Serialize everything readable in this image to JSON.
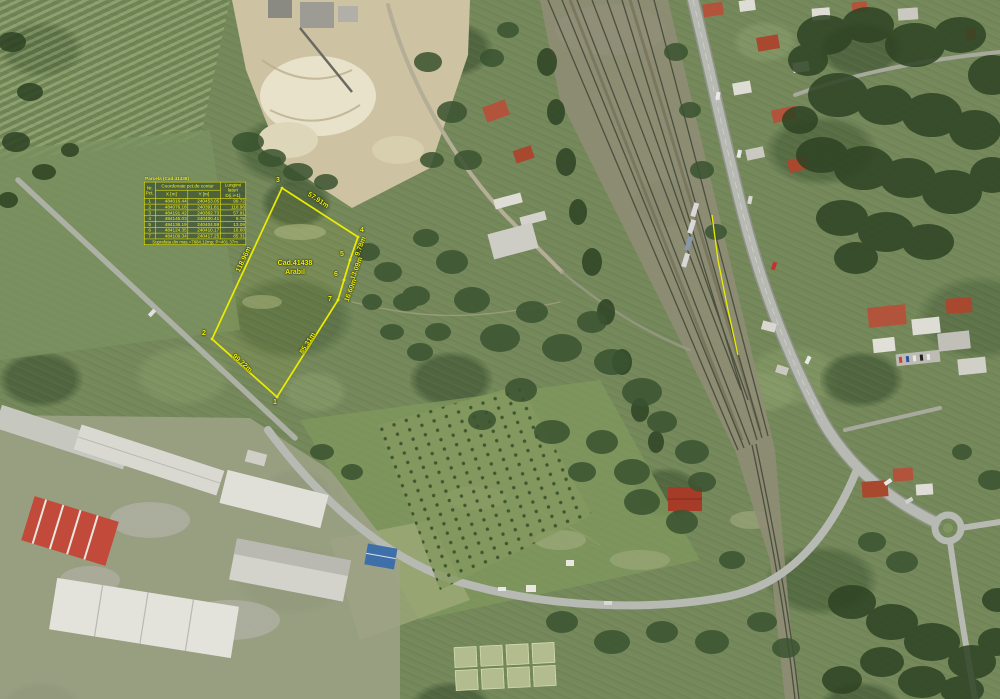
{
  "colors": {
    "overlay_yellow": "#f2f200"
  },
  "parcel": {
    "id_label": "Cad.41438",
    "use_label": "Arabil",
    "vertices": [
      "1",
      "2",
      "3",
      "4",
      "5",
      "6",
      "7"
    ],
    "edge_labels": [
      {
        "text": "57.91m"
      },
      {
        "text": "9.78m"
      },
      {
        "text": "13.09m"
      },
      {
        "text": "16.60m"
      },
      {
        "text": "85.31m"
      },
      {
        "text": "99.72m"
      },
      {
        "text": "118.96m"
      }
    ]
  },
  "coord_table": {
    "title": "Parcela (Cad.41438)",
    "header": {
      "nr": "Nr. Pct.",
      "coord": "Coordonate pct.de contur",
      "x": "X [m]",
      "y": "Y [m]",
      "len": "Lungimi laturi D(i,i+1)"
    },
    "rows": [
      {
        "pt": "1",
        "x": "484016.44",
        "y": "240453.05",
        "len": "99.72"
      },
      {
        "pt": "2",
        "x": "484076.18",
        "y": "240391.81",
        "len": "118.96"
      },
      {
        "pt": "3",
        "x": "484191.42",
        "y": "240362.73",
        "len": "57.91"
      },
      {
        "pt": "4",
        "x": "484145.03",
        "y": "240400.41",
        "len": "9.78"
      },
      {
        "pt": "5",
        "x": "484136.19",
        "y": "240404.59",
        "len": "13.09"
      },
      {
        "pt": "6",
        "x": "484124.35",
        "y": "240410.17",
        "len": "16.60"
      },
      {
        "pt": "7",
        "x": "484109.34",
        "y": "240417.25",
        "len": "85.31"
      }
    ],
    "footer": "Suprafata din mas.=7684.12mp; P=401.37m"
  }
}
